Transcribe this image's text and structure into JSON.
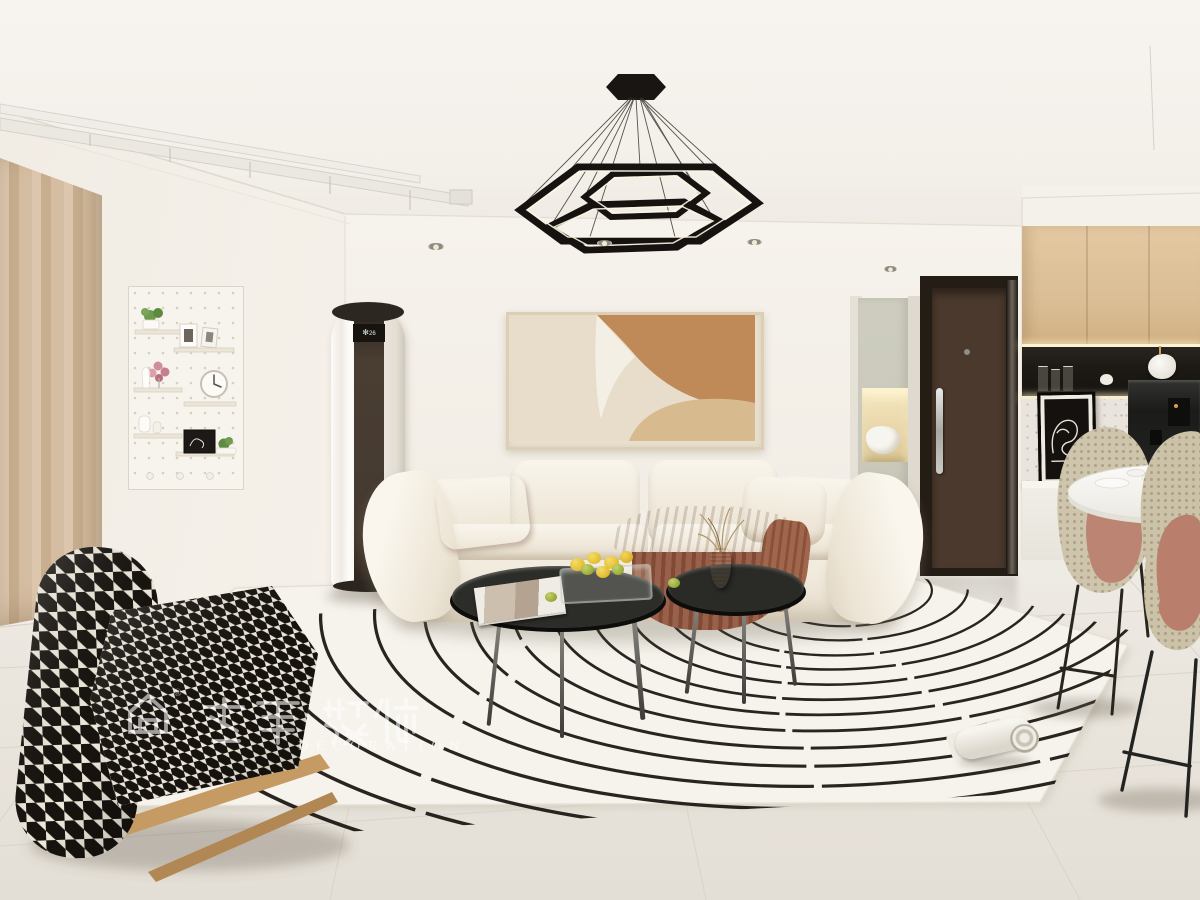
{
  "meta": {
    "type": "interior-design-render",
    "room": "cream minimalist living room with open kitchen and dining"
  },
  "watermark": {
    "cn_visible": "装饰",
    "en_visible": "DECORATION",
    "registered_mark": "®",
    "color": "#ffffff",
    "opacity": 0.58
  },
  "palette": {
    "ceiling": "#f5f2ee",
    "wall": "#f3efe8",
    "floor": "#eae5de",
    "curtain": "#d3bc9e",
    "sofa_cream": "#f4efe5",
    "rust_accent": "#a2603f",
    "art_tan": "#bf8a57",
    "art_beige": "#d7ba8e",
    "rug_base": "#f6f3ec",
    "line_black": "#17130f",
    "wood_cabinet": "#ddc29a",
    "door_wood": "#46372a",
    "mesh_chair": "#cdc3aa",
    "chair_pink": "#ba8170",
    "glass_table": "#2a2a27",
    "wood_rail": "#c49a62",
    "niche_black": "#201c18",
    "led_warm": "#f7eed6",
    "terrazzo": "#e9e4dd",
    "sage_cabinet": "#cbc9bb"
  },
  "scene": {
    "ceiling_fixtures": [
      "triple-hexagon-pendant-light",
      "recessed-downlights",
      "ceiling-drying-rack"
    ],
    "left_wall": [
      "beige-pleated-curtains",
      "white-pegboard-display-shelf",
      "cylindrical-floor-ac-unit"
    ],
    "feature_wall": [
      "abstract-tan-canvas-art",
      "cream-fabric-sofa",
      "rust-lumbar-pillow",
      "rust-throw-blanket"
    ],
    "center_floor": [
      "arc-line-area-rug",
      "smoked-glass-coffee-table-large",
      "smoked-glass-side-table",
      "fruit-tray-with-lemons",
      "magazine-on-table",
      "dried-flower-vase",
      "houndstooth-lounge-chair",
      "rolled-magazine-on-rug"
    ],
    "entry": [
      "sage-display-cabinet-with-lit-niche",
      "white-bag-in-niche",
      "dark-walnut-entry-door"
    ],
    "kitchen": [
      "oak-upper-cabinets",
      "black-open-shelf-niche",
      "terrazzo-backsplash",
      "leaning-line-art-frames",
      "black-coffee-machine",
      "white-countertop"
    ],
    "dining": [
      "round-white-marble-table",
      "rattan-shell-chairs-with-pink-seats"
    ]
  },
  "counts": {
    "pendant_hexagon_rings": 3,
    "sofa_back_cushions": 4,
    "coffee_tables": 2,
    "dining_chairs_visible": 2,
    "downlights_visible": 4
  }
}
